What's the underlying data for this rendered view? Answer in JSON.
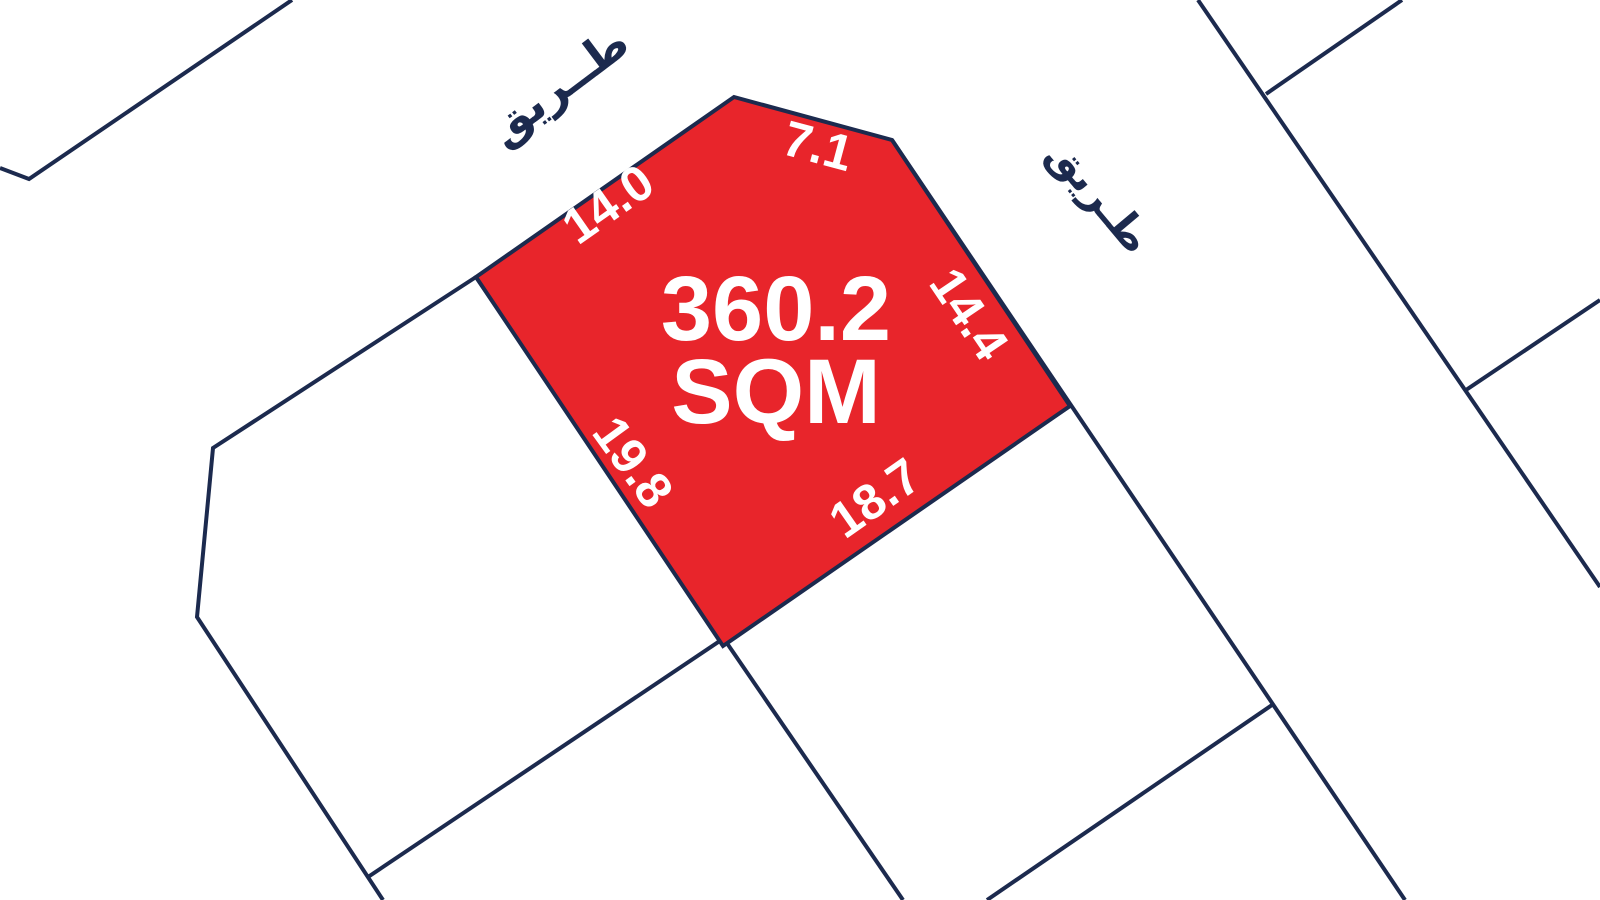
{
  "map": {
    "plot": {
      "area_value": "360.2",
      "area_unit": "SQM",
      "dimensions": {
        "top_left_edge": "14.0",
        "top_edge": "7.1",
        "right_edge": "14.4",
        "bottom_right_edge": "18.7",
        "bottom_left_edge": "19.8"
      }
    },
    "road_labels": {
      "top_road": "طــريق",
      "right_road": "طـريق"
    },
    "colors": {
      "plot_fill": "#E8252B",
      "boundary_line": "#1C2A4E",
      "dimension_text": "#FFFFFF",
      "road_text": "#1C2A4E",
      "background": "#FFFFFF"
    }
  }
}
